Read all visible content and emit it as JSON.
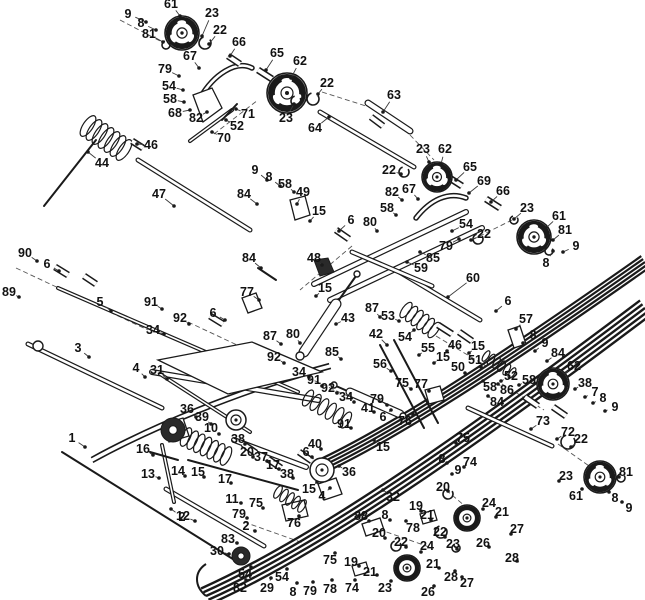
{
  "canvas": {
    "width": 645,
    "height": 600,
    "background": "#ffffff",
    "ink": "#1a1a1a",
    "leader": "#3a3a3a"
  },
  "diagram_title": "exploded-parts-diagram",
  "labels": [
    [
      "9",
      128,
      14,
      146,
      22
    ],
    [
      "61",
      171,
      4,
      180,
      16
    ],
    [
      "8",
      141,
      23,
      156,
      30
    ],
    [
      "81",
      149,
      34,
      163,
      42
    ],
    [
      "23",
      212,
      13,
      202,
      36
    ],
    [
      "22",
      220,
      30,
      209,
      44
    ],
    [
      "66",
      239,
      42,
      230,
      56
    ],
    [
      "67",
      190,
      56,
      199,
      68
    ],
    [
      "65",
      277,
      53,
      266,
      70
    ],
    [
      "62",
      300,
      61,
      291,
      78
    ],
    [
      "79",
      165,
      69,
      179,
      76
    ],
    [
      "54",
      169,
      86,
      183,
      90
    ],
    [
      "58",
      170,
      99,
      184,
      102
    ],
    [
      "68",
      175,
      113,
      190,
      110
    ],
    [
      "82",
      196,
      118,
      207,
      112
    ],
    [
      "71",
      248,
      114,
      236,
      109
    ],
    [
      "52",
      237,
      126,
      226,
      120
    ],
    [
      "70",
      224,
      138,
      212,
      132
    ],
    [
      "23",
      286,
      118,
      294,
      104
    ],
    [
      "46",
      151,
      145,
      137,
      144
    ],
    [
      "44",
      102,
      163,
      88,
      152
    ],
    [
      "47",
      159,
      194,
      174,
      206
    ],
    [
      "22",
      327,
      83,
      318,
      94
    ],
    [
      "63",
      394,
      95,
      383,
      112
    ],
    [
      "64",
      315,
      128,
      329,
      117
    ],
    [
      "23",
      423,
      149,
      429,
      162
    ],
    [
      "62",
      445,
      149,
      441,
      164
    ],
    [
      "22",
      389,
      170,
      401,
      174
    ],
    [
      "65",
      470,
      167,
      456,
      180
    ],
    [
      "69",
      484,
      181,
      469,
      193
    ],
    [
      "66",
      503,
      191,
      491,
      202
    ],
    [
      "23",
      527,
      208,
      514,
      219
    ],
    [
      "61",
      559,
      216,
      546,
      228
    ],
    [
      "81",
      565,
      230,
      553,
      240
    ],
    [
      "9",
      576,
      246,
      563,
      252
    ],
    [
      "8",
      546,
      263,
      553,
      251
    ],
    [
      "54",
      466,
      224,
      452,
      231
    ],
    [
      "22",
      484,
      234,
      471,
      240
    ],
    [
      "79",
      446,
      246,
      459,
      239
    ],
    [
      "85",
      433,
      258,
      420,
      252
    ],
    [
      "59",
      421,
      268,
      407,
      262
    ],
    [
      "60",
      473,
      278,
      448,
      297
    ],
    [
      "9",
      255,
      170,
      267,
      180
    ],
    [
      "8",
      269,
      177,
      280,
      186
    ],
    [
      "58",
      285,
      184,
      294,
      192
    ],
    [
      "49",
      303,
      192,
      297,
      204
    ],
    [
      "84",
      244,
      194,
      257,
      204
    ],
    [
      "15",
      319,
      211,
      310,
      221
    ],
    [
      "6",
      351,
      220,
      339,
      231
    ],
    [
      "80",
      370,
      222,
      377,
      231
    ],
    [
      "82",
      392,
      192,
      402,
      200
    ],
    [
      "67",
      409,
      189,
      418,
      199
    ],
    [
      "58",
      387,
      208,
      396,
      215
    ],
    [
      "48",
      314,
      258,
      322,
      265
    ],
    [
      "84",
      249,
      258,
      261,
      268
    ],
    [
      "77",
      247,
      292,
      259,
      300
    ],
    [
      "15",
      325,
      288,
      316,
      296
    ],
    [
      "87",
      372,
      308,
      380,
      317
    ],
    [
      "43",
      348,
      318,
      336,
      324
    ],
    [
      "53",
      388,
      316,
      399,
      321
    ],
    [
      "54",
      405,
      337,
      414,
      330
    ],
    [
      "42",
      376,
      334,
      387,
      345
    ],
    [
      "56",
      380,
      364,
      391,
      371
    ],
    [
      "87",
      270,
      336,
      281,
      344
    ],
    [
      "80",
      293,
      334,
      300,
      343
    ],
    [
      "92",
      274,
      357,
      284,
      363
    ],
    [
      "34",
      299,
      372,
      309,
      377
    ],
    [
      "91",
      314,
      380,
      322,
      386
    ],
    [
      "85",
      332,
      352,
      341,
      359
    ],
    [
      "92",
      328,
      388,
      337,
      393
    ],
    [
      "34",
      346,
      397,
      354,
      402
    ],
    [
      "41",
      368,
      408,
      374,
      412
    ],
    [
      "91",
      344,
      424,
      351,
      428
    ],
    [
      "6",
      213,
      313,
      225,
      320
    ],
    [
      "91",
      151,
      302,
      162,
      309
    ],
    [
      "34",
      153,
      330,
      164,
      334
    ],
    [
      "92",
      180,
      318,
      189,
      324
    ],
    [
      "5",
      100,
      302,
      111,
      311
    ],
    [
      "90",
      25,
      253,
      37,
      261
    ],
    [
      "6",
      47,
      264,
      59,
      271
    ],
    [
      "89",
      9,
      292,
      19,
      297
    ],
    [
      "3",
      78,
      348,
      89,
      357
    ],
    [
      "4",
      136,
      368,
      145,
      377
    ],
    [
      "31",
      157,
      370,
      167,
      379
    ],
    [
      "6",
      508,
      301,
      496,
      311
    ],
    [
      "57",
      526,
      319,
      516,
      329
    ],
    [
      "8",
      533,
      335,
      523,
      343
    ],
    [
      "9",
      545,
      343,
      535,
      351
    ],
    [
      "84",
      558,
      353,
      547,
      361
    ],
    [
      "58",
      529,
      380,
      519,
      385
    ],
    [
      "62",
      574,
      366,
      563,
      375
    ],
    [
      "38",
      585,
      383,
      575,
      389
    ],
    [
      "7",
      595,
      392,
      585,
      397
    ],
    [
      "8",
      603,
      398,
      593,
      403
    ],
    [
      "9",
      615,
      407,
      605,
      411
    ],
    [
      "55",
      428,
      348,
      419,
      355
    ],
    [
      "15",
      443,
      357,
      434,
      363
    ],
    [
      "46",
      455,
      345,
      447,
      351
    ],
    [
      "15",
      478,
      346,
      469,
      353
    ],
    [
      "75",
      402,
      383,
      411,
      389
    ],
    [
      "77",
      421,
      384,
      429,
      391
    ],
    [
      "79",
      377,
      399,
      387,
      405
    ],
    [
      "76",
      405,
      421,
      413,
      414
    ],
    [
      "6",
      383,
      417,
      391,
      410
    ],
    [
      "50",
      458,
      367,
      465,
      373
    ],
    [
      "51",
      475,
      360,
      481,
      367
    ],
    [
      "52",
      511,
      376,
      501,
      381
    ],
    [
      "86",
      507,
      390,
      498,
      384
    ],
    [
      "58",
      490,
      387,
      483,
      381
    ],
    [
      "84",
      497,
      402,
      488,
      396
    ],
    [
      "73",
      543,
      421,
      531,
      429
    ],
    [
      "72",
      568,
      432,
      557,
      439
    ],
    [
      "22",
      581,
      439,
      571,
      447
    ],
    [
      "15",
      383,
      447,
      374,
      440
    ],
    [
      "36",
      349,
      472,
      339,
      466
    ],
    [
      "32",
      393,
      497,
      383,
      490
    ],
    [
      "4",
      322,
      496,
      330,
      488
    ],
    [
      "15",
      309,
      489,
      317,
      482
    ],
    [
      "1",
      72,
      438,
      85,
      447
    ],
    [
      "36",
      187,
      409,
      196,
      417
    ],
    [
      "39",
      202,
      417,
      211,
      424
    ],
    [
      "10",
      211,
      428,
      219,
      434
    ],
    [
      "16",
      143,
      449,
      153,
      455
    ],
    [
      "13",
      148,
      474,
      159,
      478
    ],
    [
      "14",
      178,
      471,
      185,
      476
    ],
    [
      "15",
      198,
      472,
      204,
      477
    ],
    [
      "17",
      225,
      479,
      231,
      483
    ],
    [
      "12",
      183,
      516,
      195,
      521
    ],
    [
      "38",
      238,
      439,
      245,
      444
    ],
    [
      "20",
      247,
      452,
      253,
      457
    ],
    [
      "37",
      261,
      457,
      267,
      461
    ],
    [
      "17",
      273,
      465,
      279,
      469
    ],
    [
      "38",
      287,
      474,
      293,
      478
    ],
    [
      "6",
      306,
      452,
      312,
      457
    ],
    [
      "40",
      315,
      444,
      321,
      449
    ],
    [
      "11",
      232,
      499,
      241,
      503
    ],
    [
      "75",
      256,
      503,
      263,
      508
    ],
    [
      "79",
      239,
      514,
      247,
      518
    ],
    [
      "2",
      182,
      517,
      171,
      509
    ],
    [
      "2",
      246,
      526,
      255,
      531
    ],
    [
      "83",
      228,
      539,
      237,
      543
    ],
    [
      "30",
      217,
      551,
      229,
      554
    ],
    [
      "54",
      245,
      574,
      251,
      567
    ],
    [
      "82",
      240,
      588,
      246,
      580
    ],
    [
      "29",
      267,
      588,
      271,
      578
    ],
    [
      "54",
      282,
      577,
      287,
      569
    ],
    [
      "8",
      293,
      592,
      297,
      583
    ],
    [
      "79",
      310,
      591,
      313,
      582
    ],
    [
      "78",
      330,
      589,
      332,
      580
    ],
    [
      "75",
      330,
      560,
      335,
      553
    ],
    [
      "76",
      294,
      523,
      299,
      516
    ],
    [
      "88",
      361,
      516,
      369,
      521
    ],
    [
      "8",
      385,
      515,
      390,
      520
    ],
    [
      "78",
      413,
      528,
      406,
      521
    ],
    [
      "19",
      416,
      506,
      421,
      511
    ],
    [
      "21",
      427,
      515,
      431,
      520
    ],
    [
      "20",
      379,
      533,
      385,
      538
    ],
    [
      "22",
      401,
      542,
      406,
      547
    ],
    [
      "19",
      351,
      562,
      359,
      566
    ],
    [
      "21",
      370,
      572,
      377,
      575
    ],
    [
      "22",
      440,
      532,
      445,
      537
    ],
    [
      "23",
      453,
      544,
      457,
      549
    ],
    [
      "24",
      489,
      503,
      483,
      509
    ],
    [
      "24",
      427,
      546,
      421,
      552
    ],
    [
      "23",
      385,
      588,
      391,
      581
    ],
    [
      "21",
      433,
      564,
      439,
      568
    ],
    [
      "26",
      428,
      592,
      434,
      586
    ],
    [
      "28",
      451,
      577,
      455,
      571
    ],
    [
      "27",
      467,
      583,
      462,
      577
    ],
    [
      "74",
      352,
      588,
      355,
      580
    ],
    [
      "75",
      463,
      438,
      456,
      443
    ],
    [
      "8",
      442,
      459,
      447,
      463
    ],
    [
      "74",
      470,
      462,
      464,
      467
    ],
    [
      "9",
      458,
      470,
      452,
      474
    ],
    [
      "20",
      443,
      487,
      448,
      491
    ],
    [
      "21",
      502,
      512,
      496,
      517
    ],
    [
      "26",
      483,
      543,
      489,
      547
    ],
    [
      "28",
      512,
      558,
      517,
      561
    ],
    [
      "27",
      517,
      529,
      511,
      534
    ],
    [
      "23",
      566,
      476,
      559,
      481
    ],
    [
      "61",
      576,
      496,
      582,
      489
    ],
    [
      "81",
      626,
      472,
      619,
      477
    ],
    [
      "8",
      615,
      498,
      609,
      492
    ],
    [
      "9",
      629,
      508,
      622,
      502
    ]
  ],
  "wheels": [
    [
      182,
      33,
      17,
      "big"
    ],
    [
      287,
      93,
      20,
      "big"
    ],
    [
      437,
      177,
      15,
      "big"
    ],
    [
      534,
      237,
      17,
      "big"
    ],
    [
      553,
      384,
      16,
      "big"
    ],
    [
      600,
      477,
      16,
      "big"
    ],
    [
      467,
      518,
      13,
      "big"
    ],
    [
      407,
      568,
      13,
      "big"
    ],
    [
      322,
      470,
      12,
      "plain"
    ],
    [
      236,
      420,
      10,
      "plain"
    ],
    [
      173,
      430,
      12,
      "dark"
    ],
    [
      241,
      556,
      9,
      "dark"
    ]
  ],
  "rods": [
    [
      138,
      160,
      250,
      230,
      5
    ],
    [
      44,
      206,
      96,
      140,
      2
    ],
    [
      58,
      288,
      298,
      392,
      4
    ],
    [
      28,
      344,
      162,
      408,
      5
    ],
    [
      190,
      141,
      232,
      110,
      4
    ],
    [
      237,
      104,
      222,
      120,
      2
    ],
    [
      368,
      103,
      410,
      131,
      7
    ],
    [
      320,
      112,
      414,
      167,
      5
    ],
    [
      396,
      270,
      480,
      320,
      5
    ],
    [
      468,
      408,
      552,
      446,
      5
    ],
    [
      166,
      489,
      264,
      546,
      5
    ],
    [
      62,
      452,
      236,
      561,
      2
    ],
    [
      380,
      345,
      424,
      428,
      2
    ],
    [
      394,
      340,
      438,
      423,
      2
    ],
    [
      188,
      460,
      298,
      490,
      2
    ],
    [
      234,
      440,
      306,
      467,
      6
    ],
    [
      314,
      284,
      466,
      212,
      6
    ],
    [
      330,
      300,
      482,
      228,
      6
    ],
    [
      352,
      252,
      432,
      286,
      5
    ],
    [
      356,
      276,
      336,
      304,
      2
    ],
    [
      336,
      304,
      304,
      352,
      11
    ],
    [
      336,
      386,
      352,
      393,
      2
    ],
    [
      350,
      392,
      400,
      414,
      9
    ],
    [
      162,
      445,
      174,
      502,
      4
    ],
    [
      150,
      452,
      178,
      460,
      2
    ],
    [
      152,
      372,
      318,
      400,
      6
    ],
    [
      160,
      374,
      250,
      432,
      4
    ],
    [
      258,
      268,
      276,
      280,
      2
    ]
  ],
  "springs": [
    [
      88,
      126,
      124,
      150,
      12,
      7
    ],
    [
      406,
      310,
      434,
      330,
      9,
      6
    ],
    [
      186,
      437,
      226,
      456,
      10,
      7
    ],
    [
      308,
      398,
      346,
      420,
      9,
      6
    ],
    [
      486,
      356,
      512,
      373,
      6,
      6
    ],
    [
      278,
      492,
      302,
      506,
      7,
      5
    ]
  ],
  "rails": [
    {
      "path": "M 206 596 C 320 545 470 440 645 308",
      "x1": 206,
      "y1": 596,
      "x2": 645,
      "y2": 308,
      "offsets": [
        -9,
        -4.5,
        0,
        4.5,
        9
      ],
      "w": 2.4
    },
    {
      "path": "M 318 468 C 400 430 520 350 645 262",
      "x1": 318,
      "y1": 468,
      "x2": 645,
      "y2": 262,
      "offsets": [
        -7,
        -3.5,
        0,
        3.5,
        7
      ],
      "w": 2.2
    },
    {
      "path": "M 92 460 C 150 428 240 390 330 366",
      "x1": 92,
      "y1": 460,
      "x2": 330,
      "y2": 366,
      "offsets": [
        -2.5,
        2.5
      ],
      "w": 1.6
    },
    {
      "path": "M 206 596 C 194 586 194 572 206 564",
      "x1": 206,
      "y1": 596,
      "x2": 206,
      "y2": 564,
      "offsets": [
        0
      ],
      "w": 2.0
    }
  ],
  "hooks": [
    "M 200 98 C 214 74 236 60 252 68",
    "M 416 218 C 430 200 448 191 466 198"
  ],
  "dashes": [
    [
      214,
      134,
      258,
      100
    ],
    [
      322,
      92,
      366,
      106
    ],
    [
      410,
      135,
      434,
      160
    ],
    [
      352,
      246,
      300,
      290
    ],
    [
      188,
      322,
      252,
      352
    ],
    [
      300,
      374,
      352,
      398
    ],
    [
      436,
      336,
      486,
      366
    ],
    [
      502,
      384,
      544,
      410
    ],
    [
      364,
      524,
      432,
      548
    ],
    [
      446,
      490,
      472,
      512
    ],
    [
      558,
      444,
      592,
      468
    ],
    [
      16,
      268,
      148,
      330
    ],
    [
      120,
      20,
      162,
      42
    ],
    [
      472,
      240,
      512,
      220
    ],
    [
      244,
      522,
      306,
      544
    ]
  ],
  "polys": [
    "193,95 212,88 222,108 203,122",
    "290,200 305,196 310,215 295,220",
    "508,330 520,326 526,344 514,348",
    "163,424 183,418 189,436 169,442",
    "318,484 336,478 342,494 324,500",
    "282,505 304,500 308,516 286,521",
    "362,524 380,518 384,530 366,536",
    "420,514 434,510 437,520 423,524",
    "352,566 366,562 369,572 355,576",
    "242,298 256,293 262,308 248,313",
    "425,390 440,386 444,400 429,404",
    "158,360 252,342 322,372 228,394"
  ],
  "knuckle": "314,260 328,258 334,272 320,276",
  "bushings": [
    [
      228,
      56,
      240,
      64
    ],
    [
      258,
      70,
      272,
      79
    ],
    [
      448,
      177,
      462,
      186
    ],
    [
      486,
      199,
      500,
      208
    ],
    [
      132,
      141,
      143,
      148
    ],
    [
      55,
      267,
      68,
      275
    ],
    [
      84,
      276,
      96,
      284
    ],
    [
      210,
      316,
      223,
      324
    ],
    [
      336,
      230,
      349,
      239
    ],
    [
      438,
      325,
      452,
      334
    ],
    [
      459,
      332,
      472,
      341
    ],
    [
      299,
      452,
      312,
      461
    ],
    [
      268,
      459,
      281,
      468
    ],
    [
      243,
      444,
      256,
      453
    ],
    [
      525,
      397,
      538,
      406
    ],
    [
      553,
      407,
      566,
      416
    ],
    [
      371,
      117,
      383,
      126
    ]
  ],
  "rings": [
    [
      205,
      43,
      6
    ],
    [
      296,
      101,
      5
    ],
    [
      313,
      99,
      6
    ],
    [
      404,
      172,
      5
    ],
    [
      478,
      239,
      5
    ],
    [
      166,
      45,
      4
    ],
    [
      549,
      251,
      4
    ],
    [
      568,
      442,
      7
    ],
    [
      441,
      532,
      6
    ],
    [
      456,
      548,
      4
    ],
    [
      396,
      546,
      5
    ],
    [
      448,
      494,
      5
    ],
    [
      621,
      478,
      4
    ],
    [
      514,
      220,
      4
    ]
  ],
  "eyelets": [
    [
      357,
      274,
      3
    ],
    [
      300,
      356,
      4
    ],
    [
      334,
      385,
      3
    ],
    [
      403,
      416,
      3
    ],
    [
      38,
      346,
      5
    ]
  ]
}
